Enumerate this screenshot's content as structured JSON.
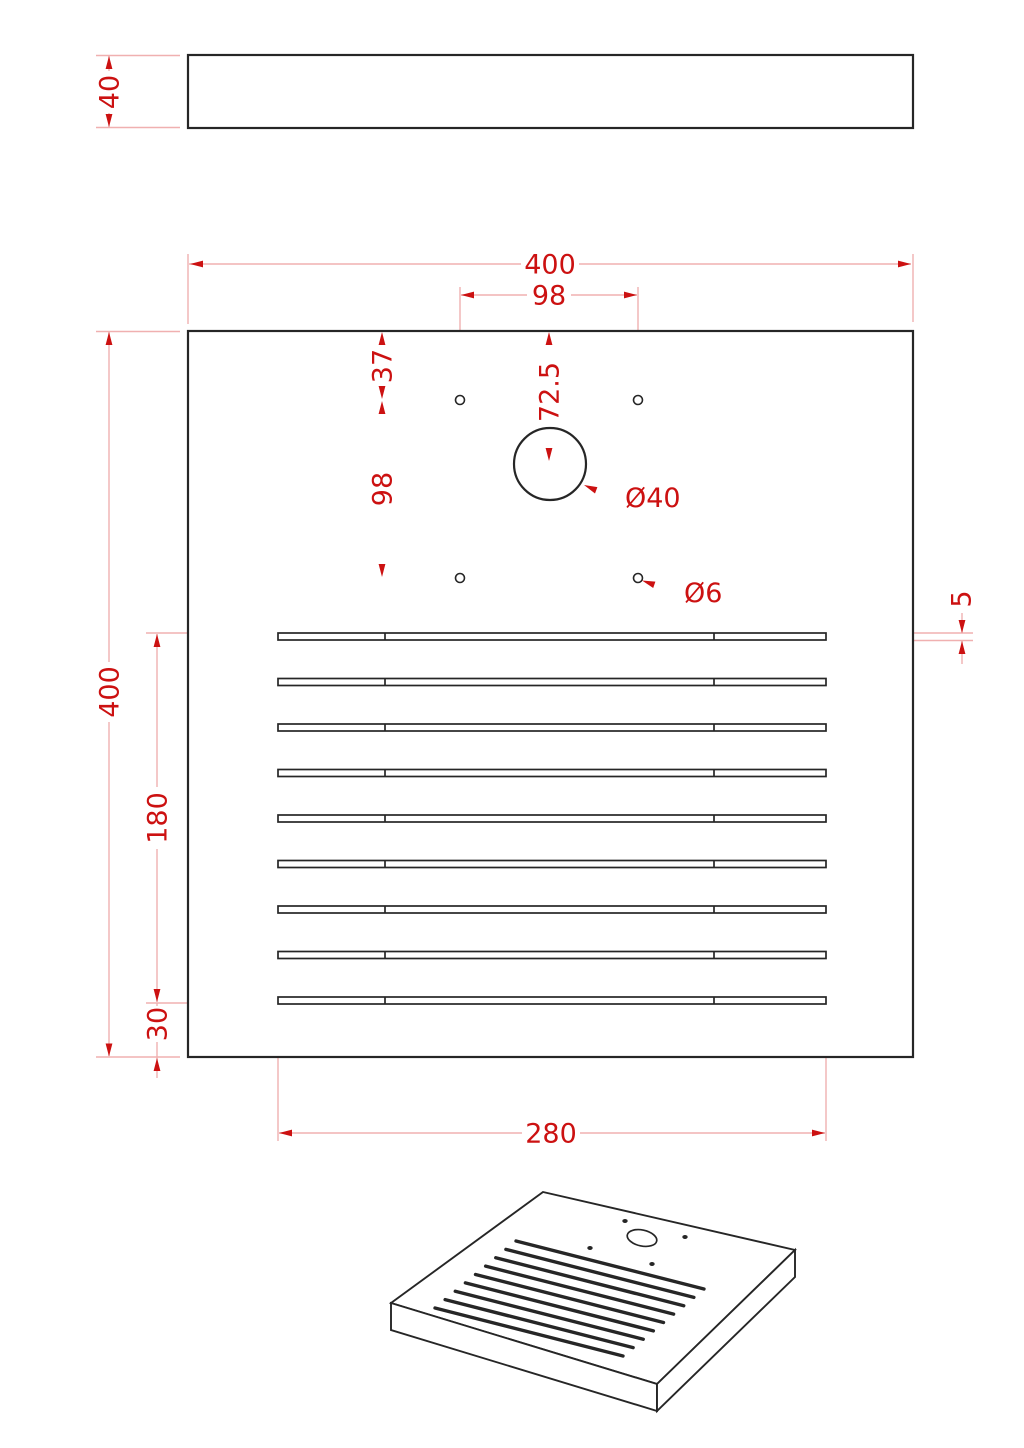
{
  "drawing": {
    "type": "technical-drawing",
    "part": "slotted drip tray plate",
    "views": [
      "side view",
      "front view",
      "isometric view"
    ]
  },
  "dims": {
    "side_thickness": "40",
    "width": "400",
    "height": "400",
    "hole_pitch_x": "98",
    "hole_top_offset": "37",
    "circle_center_offset": "72.5",
    "circle_diameter": "Ø40",
    "hole_pitch_y": "98",
    "hole_diameter": "Ø6",
    "slot_height": "5",
    "slot_field_height": "180",
    "slot_bottom_margin": "30",
    "slot_length": "280"
  },
  "colors": {
    "outline": "#262626",
    "dimension_lines": "#f0b0b0",
    "dimension_text": "#cc1111",
    "background": "#ffffff"
  }
}
